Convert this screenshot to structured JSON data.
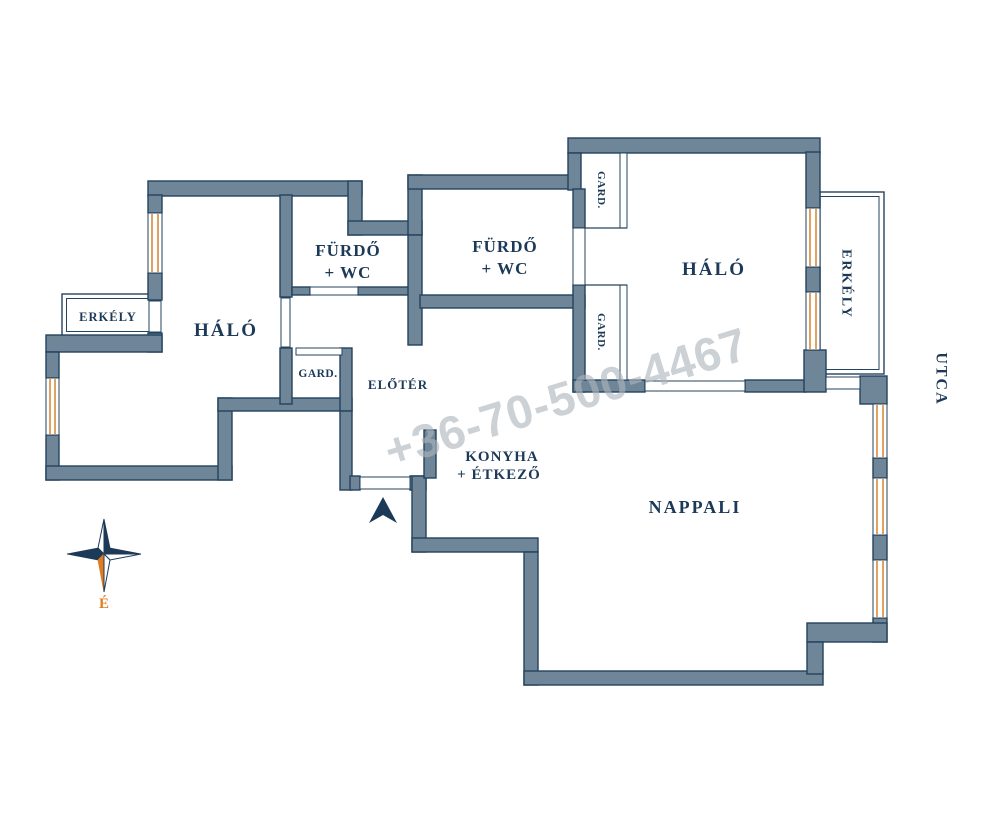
{
  "rooms": {
    "bedroom_left": "HÁLÓ",
    "bedroom_right": "HÁLÓ",
    "bathroom_1_line1": "FÜRDŐ",
    "bathroom_1_line2": "+ WC",
    "bathroom_2_line1": "FÜRDŐ",
    "bathroom_2_line2": "+ WC",
    "balcony_left": "ERKÉLY",
    "balcony_right": "ERKÉLY",
    "wardrobe_hall": "GARD.",
    "wardrobe_closet_1": "GARD.",
    "wardrobe_closet_2": "GARD.",
    "hall": "ELŐTÉR",
    "kitchen_line1": "KONYHA",
    "kitchen_line2": "+ ÉTKEZŐ",
    "living_room": "NAPPALI",
    "street": "UTCA"
  },
  "compass": {
    "north_label": "É"
  },
  "watermark": {
    "text": "+36-70-500-4467"
  },
  "colors": {
    "wall": "#6e8697",
    "outline": "#24435e",
    "label": "#1c3a57",
    "window": "#d98a3c",
    "compass_orange": "#e07b22",
    "watermark": "#aeb5bd"
  }
}
